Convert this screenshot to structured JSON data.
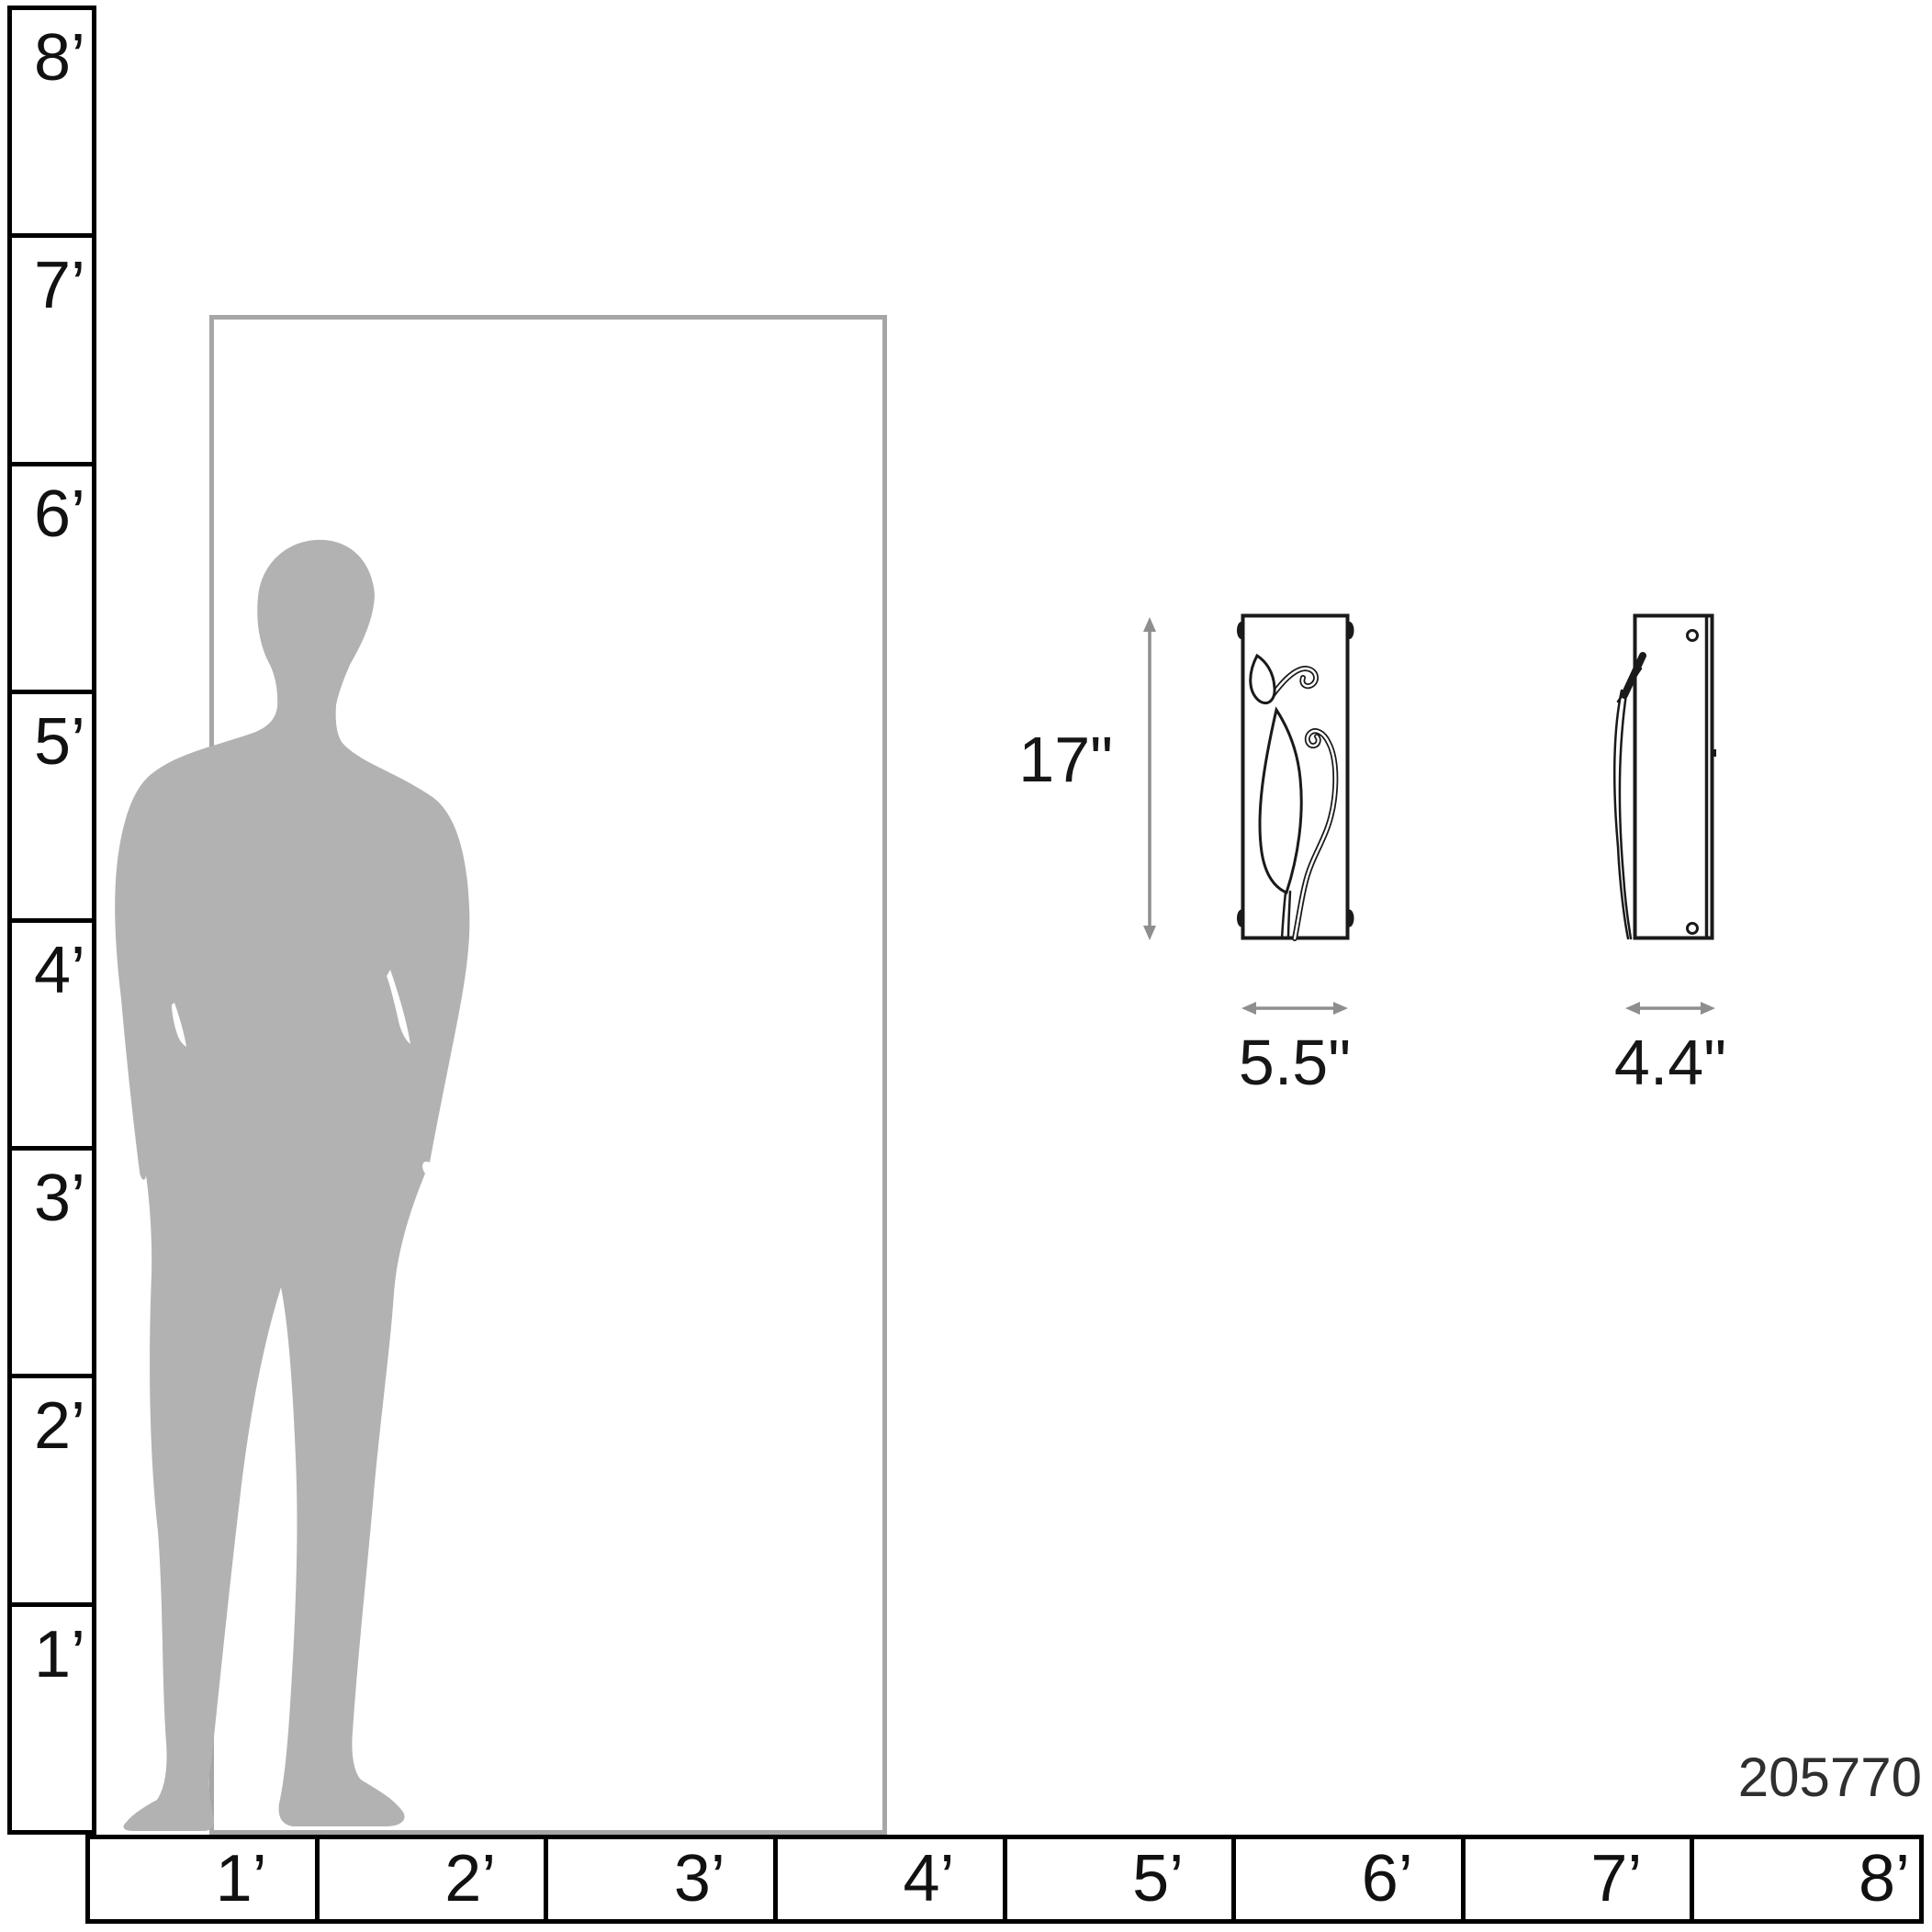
{
  "diagram": {
    "type": "product-size-comparison",
    "product": {
      "number": "205770"
    },
    "dimensions": {
      "height_label": "17\"",
      "width_label": "5.5\"",
      "depth_label": "4.4\""
    },
    "rulers": {
      "vertical_feet_labels": [
        "8’",
        "7’",
        "6’",
        "5’",
        "4’",
        "3’",
        "2’",
        "1’"
      ],
      "horizontal_feet_labels": [
        "1’",
        "2’",
        "3’",
        "4’",
        "5’",
        "6’",
        "7’",
        "8’"
      ]
    },
    "reference_objects": {
      "door": "door-outline",
      "person": "standing-man-silhouette"
    },
    "views": {
      "front": "sconce-front-view-with-leaf-vine-motif",
      "side": "sconce-side-view-with-mounting-screws"
    },
    "icons": {
      "height_arrow": "vertical-double-headed-arrow",
      "width_arrow": "horizontal-double-headed-arrow",
      "depth_arrow": "horizontal-double-headed-arrow"
    },
    "colors": {
      "ruler_line": "#000000",
      "ruler_text": "#111111",
      "door_outline": "#a6a6a6",
      "silhouette": "#b2b2b2",
      "dimension_arrow": "#8e8e8e",
      "fixture_line": "#1a1a1a",
      "label_text": "#161616",
      "product_number_text": "#2f2f2f",
      "background": "#ffffff"
    }
  }
}
